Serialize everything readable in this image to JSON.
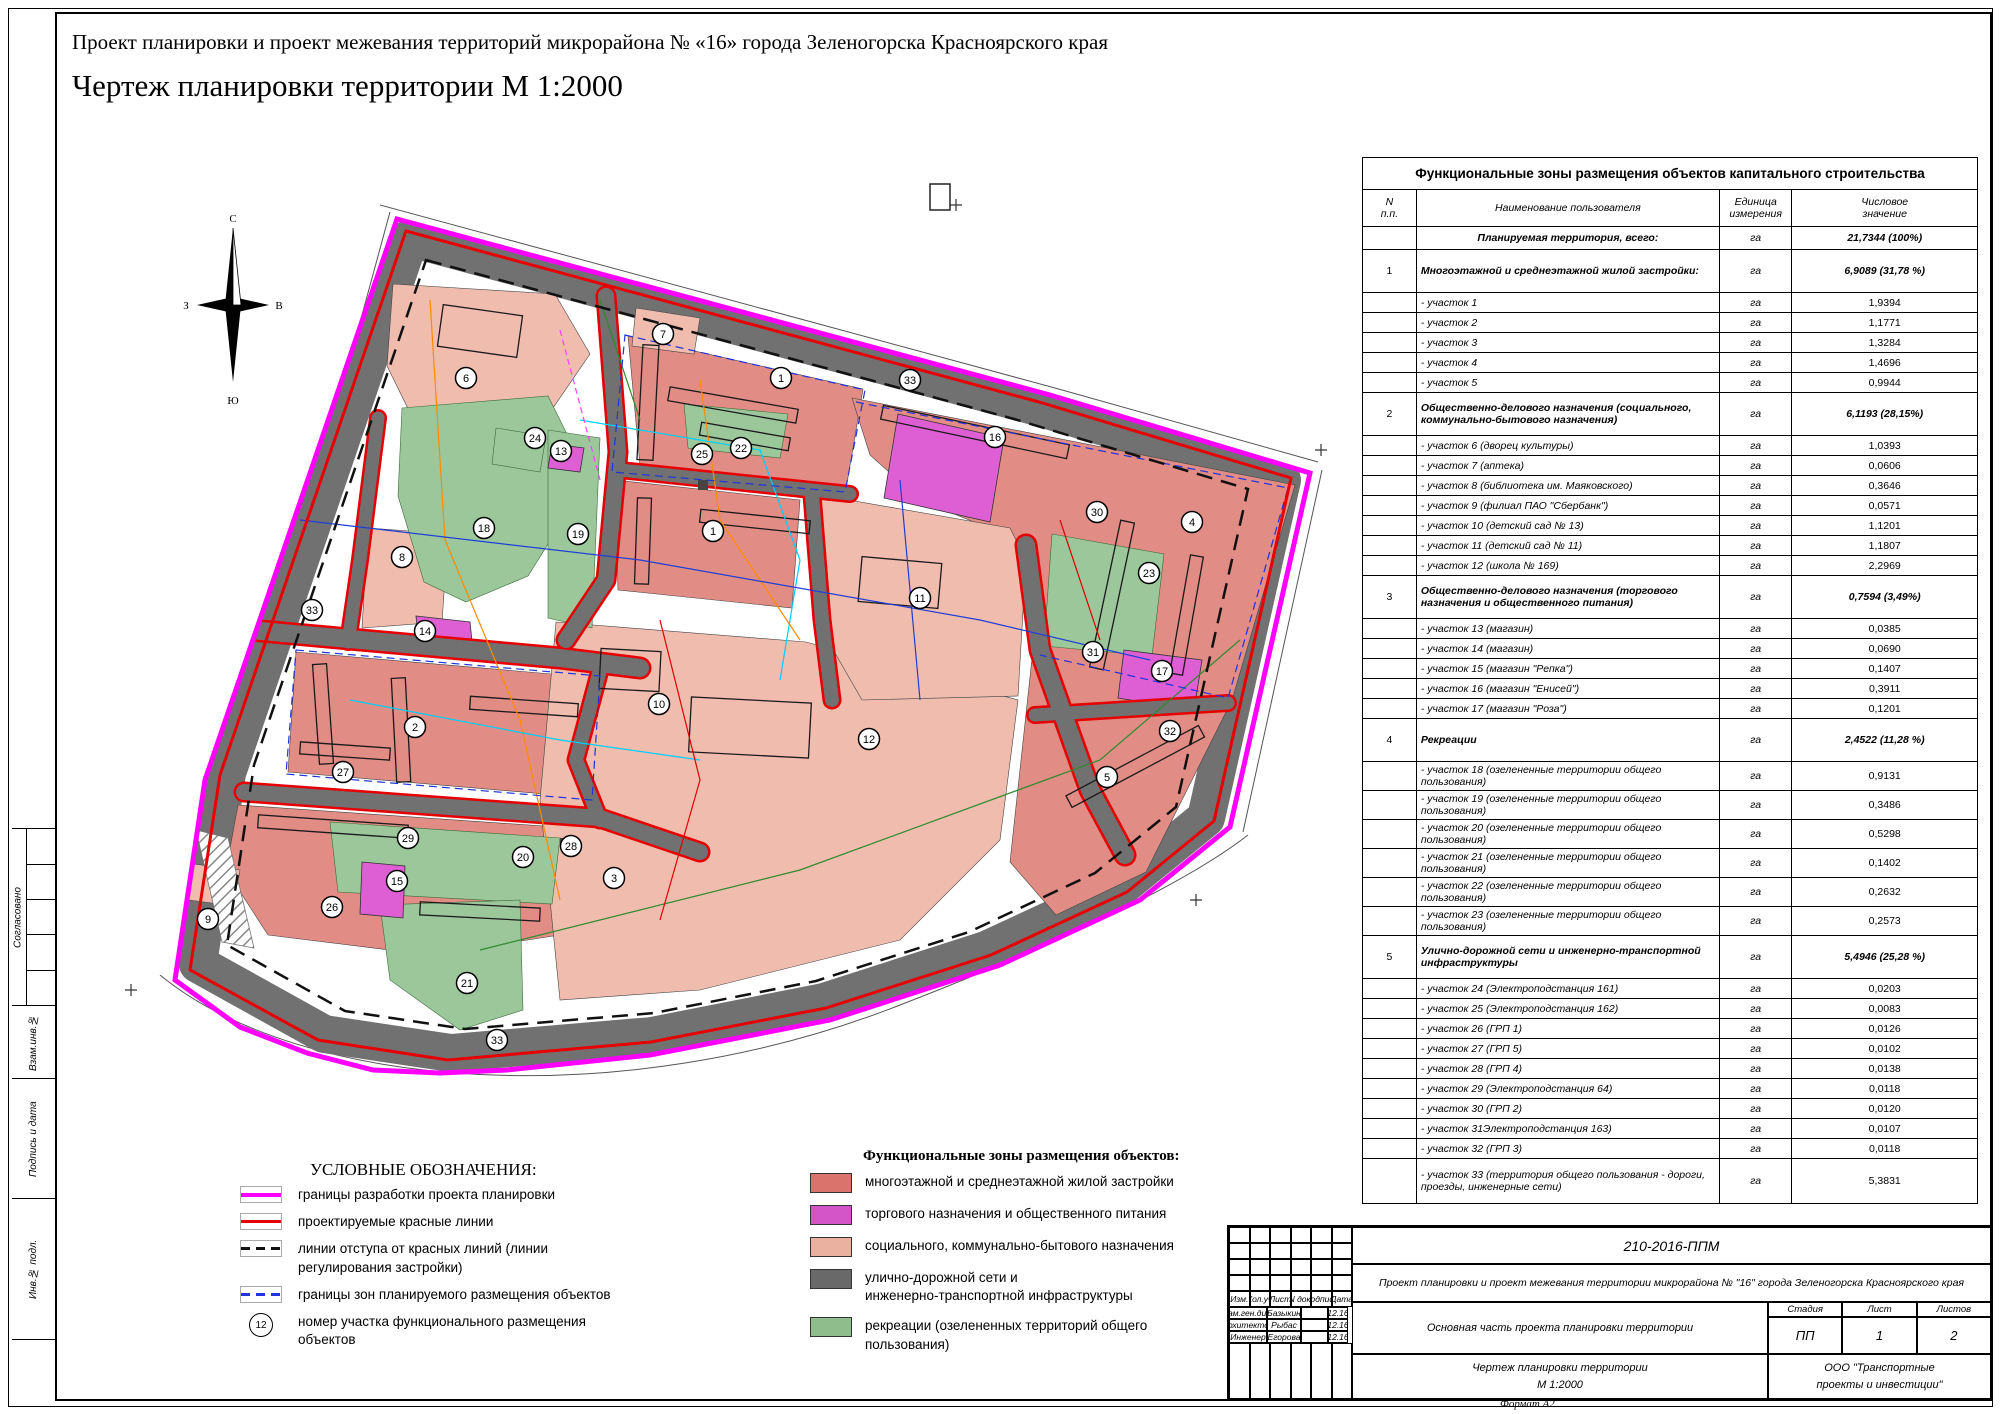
{
  "colors": {
    "boundary": "#FF00FF",
    "redline": "#E60000",
    "blueline": "#2233DD",
    "zone-res": "#E18C84",
    "zone-soc": "#EFBCAE",
    "zone-trade": "#DD5FD3",
    "zone-road": "#717171",
    "zone-rec": "#9CC79A",
    "legend-res": "#D9736C",
    "legend-soc": "#EAB0A0",
    "legend-trade": "#D455C8",
    "legend-road": "#696969",
    "legend-rec": "#8FBE8C"
  },
  "titles": {
    "project": "Проект планировки и проект межевания территорий микрорайона № «16» города Зеленогорска Красноярского края",
    "drawing": "Чертеж планировки территории М 1:2000"
  },
  "compass": {
    "n": "С",
    "s": "Ю",
    "w": "З",
    "e": "В"
  },
  "side_strip": {
    "approved": "Согласовано",
    "vzam": "Взам.инв.№",
    "podpis": "Подпись и дата",
    "inv": "Инв.№ подл."
  },
  "legend_symbols": {
    "title": "УСЛОВНЫЕ ОБОЗНАЧЕНИЯ:",
    "items": [
      {
        "kind": "boundary",
        "label": "границы разработки проекта планировки"
      },
      {
        "kind": "redline",
        "label": "проектируемые красные линии"
      },
      {
        "kind": "setback",
        "label": "линии отступа от красных линий (линии\nрегулирования застройки)"
      },
      {
        "kind": "zoneborder",
        "label": "границы зон планируемого размещения объектов"
      },
      {
        "kind": "number",
        "symbol": "12",
        "label": "номер участка функционального размещения\nобъектов"
      }
    ]
  },
  "legend_zones": {
    "title": "Функциональные зоны размещения объектов:",
    "items": [
      {
        "color": "#D9736C",
        "label": "многоэтажной и среднеэтажной жилой застройки"
      },
      {
        "color": "#D455C8",
        "label": "торгового назначения и общественного питания"
      },
      {
        "color": "#EAB0A0",
        "label": "социального, коммунально-бытового назначения"
      },
      {
        "color": "#696969",
        "label": "улично-дорожной сети и\nинженерно-транспортной инфраструктуры"
      },
      {
        "color": "#8FBE8C",
        "label": "рекреации (озелененных территорий общего\nпользования)"
      }
    ]
  },
  "table": {
    "title": "Функциональные зоны размещения объектов капитального строительства",
    "headers": {
      "num": "N\nп.п.",
      "name": "Наименование пользователя",
      "unit": "Единица\nизмерения",
      "value": "Числовое\nзначение"
    },
    "rows": [
      {
        "style": "total",
        "num": "",
        "name": "Планируемая территория, всего:",
        "unit": "га",
        "value": "21,7344 (100%)"
      },
      {
        "style": "section",
        "num": "1",
        "name": "Многоэтажной и среднеэтажной жилой застройки:",
        "unit": "га",
        "value": "6,9089 (31,78 %)"
      },
      {
        "style": "item",
        "num": "",
        "name": "- участок 1",
        "unit": "га",
        "value": "1,9394"
      },
      {
        "style": "item",
        "num": "",
        "name": "- участок 2",
        "unit": "га",
        "value": "1,1771"
      },
      {
        "style": "item",
        "num": "",
        "name": "- участок 3",
        "unit": "га",
        "value": "1,3284"
      },
      {
        "style": "item",
        "num": "",
        "name": "- участок 4",
        "unit": "га",
        "value": "1,4696"
      },
      {
        "style": "item",
        "num": "",
        "name": "- участок 5",
        "unit": "га",
        "value": "0,9944"
      },
      {
        "style": "section",
        "num": "2",
        "name": "Общественно-делового назначения (социального, коммунально-бытового назначения)",
        "unit": "га",
        "value": "6,1193 (28,15%)"
      },
      {
        "style": "item",
        "num": "",
        "name": "- участок 6 (дворец культуры)",
        "unit": "га",
        "value": "1,0393"
      },
      {
        "style": "item",
        "num": "",
        "name": "- участок 7 (аптека)",
        "unit": "га",
        "value": "0,0606"
      },
      {
        "style": "item",
        "num": "",
        "name": "- участок 8 (библиотека им. Маяковского)",
        "unit": "га",
        "value": "0,3646"
      },
      {
        "style": "item",
        "num": "",
        "name": "- участок 9  (филиал ПАО \"Сбербанк\")",
        "unit": "га",
        "value": "0,0571"
      },
      {
        "style": "item",
        "num": "",
        "name": "- участок 10 (детский сад № 13)",
        "unit": "га",
        "value": "1,1201"
      },
      {
        "style": "item",
        "num": "",
        "name": "- участок 11 (детский сад № 11)",
        "unit": "га",
        "value": "1,1807"
      },
      {
        "style": "item",
        "num": "",
        "name": "- участок 12 (школа № 169)",
        "unit": "га",
        "value": "2,2969"
      },
      {
        "style": "section",
        "num": "3",
        "name": "Общественно-делового назначения (торгового назначения и общественного питания)",
        "unit": "га",
        "value": "0,7594 (3,49%)"
      },
      {
        "style": "item",
        "num": "",
        "name": "- участок 13 (магазин)",
        "unit": "га",
        "value": "0,0385"
      },
      {
        "style": "item",
        "num": "",
        "name": "- участок 14 (магазин)",
        "unit": "га",
        "value": "0,0690"
      },
      {
        "style": "item",
        "num": "",
        "name": "- участок 15 (магазин \"Репка\")",
        "unit": "га",
        "value": "0,1407"
      },
      {
        "style": "item",
        "num": "",
        "name": "- участок 16 (магазин \"Енисей\")",
        "unit": "га",
        "value": "0,3911"
      },
      {
        "style": "item",
        "num": "",
        "name": "- участок 17 (магазин \"Роза\")",
        "unit": "га",
        "value": "0,1201"
      },
      {
        "style": "section",
        "num": "4",
        "name": "Рекреации",
        "unit": "га",
        "value": "2,4522 (11,28 %)"
      },
      {
        "style": "item",
        "num": "",
        "name": "- участок 18 (озелененные территории общего пользования)",
        "unit": "га",
        "value": "0,9131"
      },
      {
        "style": "item",
        "num": "",
        "name": "- участок 19 (озелененные территории общего пользования)",
        "unit": "га",
        "value": "0,3486"
      },
      {
        "style": "item",
        "num": "",
        "name": "- участок 20 (озелененные территории общего пользования)",
        "unit": "га",
        "value": "0,5298"
      },
      {
        "style": "item",
        "num": "",
        "name": "- участок 21 (озелененные территории общего пользования)",
        "unit": "га",
        "value": "0,1402"
      },
      {
        "style": "item",
        "num": "",
        "name": "- участок 22 (озелененные территории общего пользования)",
        "unit": "га",
        "value": "0,2632"
      },
      {
        "style": "item",
        "num": "",
        "name": "- участок 23 (озелененные территории общего пользования)",
        "unit": "га",
        "value": "0,2573"
      },
      {
        "style": "section",
        "num": "5",
        "name": "Улично-дорожной сети и  инженерно-транспортной инфраструктуры",
        "unit": "га",
        "value": "5,4946 (25,28 %)"
      },
      {
        "style": "item",
        "num": "",
        "name": "- участок 24 (Электроподстанция 161)",
        "unit": "га",
        "value": "0,0203"
      },
      {
        "style": "item",
        "num": "",
        "name": "- участок 25 (Электроподстанция 162)",
        "unit": "га",
        "value": "0,0083"
      },
      {
        "style": "item",
        "num": "",
        "name": "- участок 26 (ГРП 1)",
        "unit": "га",
        "value": "0,0126"
      },
      {
        "style": "item",
        "num": "",
        "name": "- участок 27 (ГРП 5)",
        "unit": "га",
        "value": "0,0102"
      },
      {
        "style": "item",
        "num": "",
        "name": "- участок 28 (ГРП 4)",
        "unit": "га",
        "value": "0,0138"
      },
      {
        "style": "item",
        "num": "",
        "name": "- участок 29 (Электроподстанция 64)",
        "unit": "га",
        "value": "0,0118"
      },
      {
        "style": "item",
        "num": "",
        "name": "- участок 30 (ГРП 2)",
        "unit": "га",
        "value": "0,0120"
      },
      {
        "style": "item",
        "num": "",
        "name": "- участок 31Электроподстанция 163)",
        "unit": "га",
        "value": "0,0107"
      },
      {
        "style": "item",
        "num": "",
        "name": "- участок 32 (ГРП 3)",
        "unit": "га",
        "value": "0,0118"
      },
      {
        "style": "item33",
        "num": "",
        "name": "- участок 33 (территория общего пользования - дороги, проезды, инженерные сети)",
        "unit": "га",
        "value": "5,3831"
      }
    ]
  },
  "map": {
    "plot_labels": [
      {
        "n": "6",
        "x": 466,
        "y": 378
      },
      {
        "n": "7",
        "x": 663,
        "y": 334
      },
      {
        "n": "1",
        "x": 781,
        "y": 378
      },
      {
        "n": "33",
        "x": 910,
        "y": 380
      },
      {
        "n": "16",
        "x": 995,
        "y": 437
      },
      {
        "n": "24",
        "x": 535,
        "y": 438
      },
      {
        "n": "13",
        "x": 561,
        "y": 451
      },
      {
        "n": "25",
        "x": 702,
        "y": 454
      },
      {
        "n": "22",
        "x": 741,
        "y": 448
      },
      {
        "n": "18",
        "x": 484,
        "y": 528
      },
      {
        "n": "19",
        "x": 578,
        "y": 534
      },
      {
        "n": "1",
        "x": 713,
        "y": 531
      },
      {
        "n": "8",
        "x": 402,
        "y": 557
      },
      {
        "n": "30",
        "x": 1097,
        "y": 512
      },
      {
        "n": "4",
        "x": 1192,
        "y": 522
      },
      {
        "n": "23",
        "x": 1149,
        "y": 573
      },
      {
        "n": "11",
        "x": 920,
        "y": 598
      },
      {
        "n": "33",
        "x": 312,
        "y": 610
      },
      {
        "n": "14",
        "x": 425,
        "y": 631
      },
      {
        "n": "31",
        "x": 1093,
        "y": 652
      },
      {
        "n": "17",
        "x": 1162,
        "y": 671
      },
      {
        "n": "10",
        "x": 659,
        "y": 704
      },
      {
        "n": "2",
        "x": 415,
        "y": 727
      },
      {
        "n": "12",
        "x": 869,
        "y": 739
      },
      {
        "n": "32",
        "x": 1170,
        "y": 731
      },
      {
        "n": "27",
        "x": 343,
        "y": 772
      },
      {
        "n": "29",
        "x": 408,
        "y": 838
      },
      {
        "n": "28",
        "x": 571,
        "y": 846
      },
      {
        "n": "20",
        "x": 523,
        "y": 857
      },
      {
        "n": "5",
        "x": 1107,
        "y": 777
      },
      {
        "n": "3",
        "x": 614,
        "y": 878
      },
      {
        "n": "15",
        "x": 397,
        "y": 881
      },
      {
        "n": "26",
        "x": 332,
        "y": 907
      },
      {
        "n": "9",
        "x": 208,
        "y": 919
      },
      {
        "n": "21",
        "x": 467,
        "y": 983
      },
      {
        "n": "33",
        "x": 497,
        "y": 1040
      }
    ]
  },
  "stamp": {
    "doc_number": "210-2016-ППМ",
    "project": "Проект планировки и проект межевания территории микрорайона № \"16\" города Зеленогорска Красноярского края",
    "rev_headers": [
      "Изм.",
      "Кол.уч",
      "Лист",
      "N док.",
      "Подпись",
      "Дата"
    ],
    "staff": [
      {
        "role": "Зам.ген.дир.",
        "name": "Базыкин",
        "sign": "",
        "date": "12.16"
      },
      {
        "role": "Архитектор",
        "name": "Рыбас",
        "sign": "",
        "date": "12.16"
      },
      {
        "role": "Инженер",
        "name": "Егорова",
        "sign": "",
        "date": "12.16"
      }
    ],
    "section": "Основная часть проекта планировки территории",
    "stage_label": "Стадия",
    "sheet_label": "Лист",
    "sheets_label": "Листов",
    "stage": "ПП",
    "sheet": "1",
    "sheets": "2",
    "drawing": "Чертеж планировки территории\nМ 1:2000",
    "org": "ООО \"Транспортные\nпроекты и инвестиции\"",
    "format": "Формат А2"
  }
}
